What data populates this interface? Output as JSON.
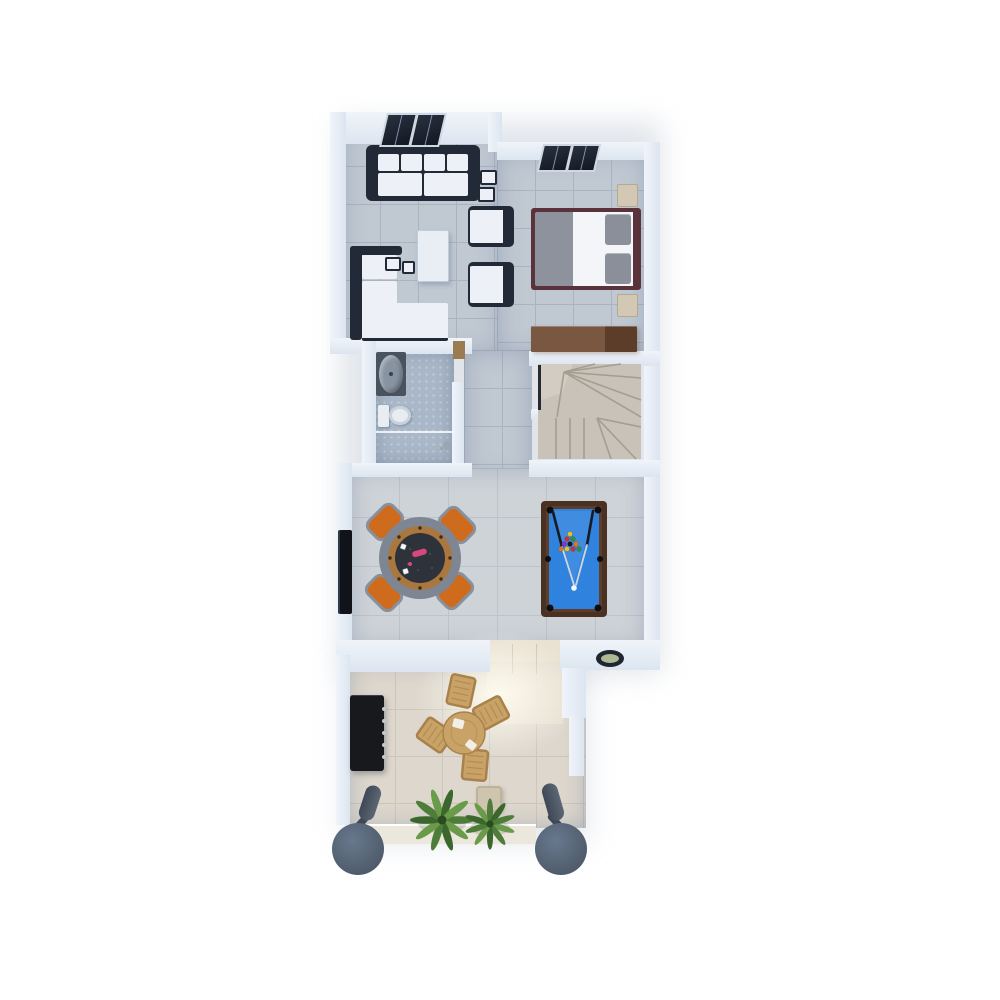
{
  "scene": {
    "title": "Top-down 3D floor plan rendering",
    "level_label": "Upper floor with game room and terrace"
  },
  "palette": {
    "background": "#ffffff",
    "wall-light": "#f0f4fa",
    "wall": "#dce5f0",
    "floor-main": "#c0c8d2",
    "tile-line": "#aab4c0",
    "floor-game": "#ced3d8",
    "game-line": "#bdc3c9",
    "floor-patio": "#ddd7cd",
    "patio-line": "#cdc6ba",
    "floor-bath": "#a9b7c8",
    "floor-entry": "#e9e1d2",
    "floor-step": "#ece7dd",
    "floor-stairs": "#c8c2b8",
    "stair-line": "#a49d90",
    "rail-dark": "#262b33",
    "sofa-frame": "#232a37",
    "cushion": "#edf1f7",
    "bed-frame": "#5a323b",
    "bed-blanket": "#8d929d",
    "bed-sheet": "#f3f5f9",
    "pillow": "#8a8f9a",
    "nightstand": "#d3c8b4",
    "nightstand-edge": "#b4a88f",
    "dresser-a": "#7a5740",
    "dresser-b": "#5c3d2a",
    "poker-rim": "#7d8692",
    "poker-wood": "#aa783f",
    "poker-felt": "#2e323b",
    "poker-logo": "#d8487e",
    "chair-orange": "#cf6b1d",
    "chair-frame": "#87909c",
    "pool-frame": "#4a3122",
    "pool-lip": "#5d3e2a",
    "pool-felt": "#2f83de",
    "pocket": "#0c0e12",
    "cue-ball": "#f4f6f8",
    "ball-1": "#e8c21d",
    "ball-2": "#cf2f2f",
    "ball-3": "#2f8f3a",
    "ball-4": "#8a2fcf",
    "ball-5": "#e2761f",
    "ball-6": "#15181e",
    "tv": "#10141a",
    "grill": "#17191d",
    "grill-knob": "#c3c9d0",
    "column": "#68788d",
    "column-dark": "#46515f",
    "post": "#3f4856",
    "plant-a": "#4e7d3a",
    "plant-b": "#699b4a",
    "plant-c": "#3c672c",
    "plant-core": "#2c4a20",
    "patio-wood": "#c8a266",
    "patio-wood-frame": "#a8824a",
    "plate": "#f2efe8",
    "dish-rim": "#202631",
    "dish-fill": "#aeb894",
    "door-wood": "#9b7b52",
    "vanity": "#49525f",
    "sink": "#8793a1",
    "toilet": "#e8edf2",
    "toilet-shadow": "#c6cfd8",
    "skylight-frame": "#cfd8e2",
    "skylight-a": "#28313f",
    "skylight-b": "#131822"
  },
  "objects": {
    "plan": "3D floor plan, top view",
    "living_sofa": "three-seat sofa",
    "side_cubes": "nesting side tables",
    "sectional": "corner sofa with chaise",
    "coffee_table": "coffee table",
    "armchair": "armchair",
    "bed": "double bed",
    "nightstand": "nightstand",
    "dresser": "wooden sideboard",
    "bathroom": "bathroom",
    "sink": "washbasin",
    "toilet": "toilet",
    "shower": "walk-in shower",
    "stairs": "winder staircase",
    "poker_table": "round poker table",
    "poker_chair": "orange game chair",
    "pool_table": "billiard table",
    "tv": "wall-mounted TV",
    "dish": "decorative bowl",
    "grill": "barbecue grill",
    "patio_table": "round outdoor dining table",
    "patio_chair": "wooden patio chair",
    "stool": "outdoor stool",
    "plants": "palm plants",
    "column": "terrace column",
    "skylight": "roof window"
  }
}
